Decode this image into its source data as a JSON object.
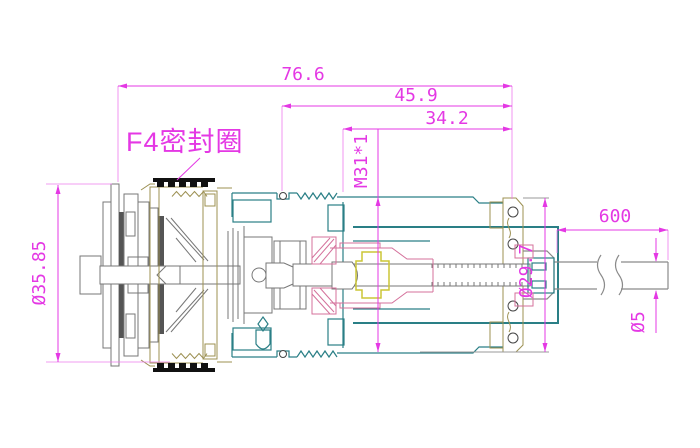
{
  "drawing": {
    "type": "engineering-cross-section",
    "label_seal": "F4密封圈",
    "dimensions": {
      "overall_length": "76.6",
      "mid_length": "45.9",
      "front_length": "34.2",
      "thread_spec": "M31*1",
      "flange_diameter": "Ø35.85",
      "body_diameter": "Ø29.7",
      "cable_length": "600",
      "cable_diameter": "Ø5"
    },
    "colors": {
      "dimension_magenta": "#e438e4",
      "body_teal": "#2a7f86",
      "shell_tan": "#9c9052",
      "detail_gray": "#777777",
      "insulator_pink": "#d4719b",
      "insulator_yellow": "#cbc636",
      "seal_black": "#111111",
      "background": "#ffffff"
    }
  }
}
